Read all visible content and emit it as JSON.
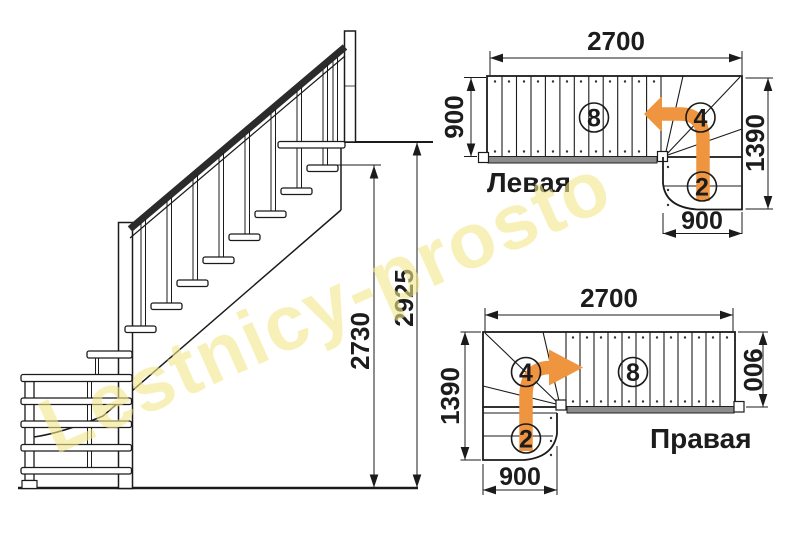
{
  "watermark": {
    "text": "Lestnicy-prosto",
    "color": "#F2E88C"
  },
  "colors": {
    "line": "#1b1b1b",
    "arrow_orange": "#EF9540",
    "stringer_gray": "#8C8C8C"
  },
  "elevation": {
    "dim_stair_height": "2730",
    "dim_total_height": "2925"
  },
  "plans": {
    "left": {
      "label": "Левая",
      "dim_length": "2700",
      "dim_width": "900",
      "dim_total_width": "1390",
      "dim_bottom_width": "900",
      "flight_steps": "8",
      "winder_steps": "4",
      "bottom_steps": "2"
    },
    "right": {
      "label": "Правая",
      "dim_length": "2700",
      "dim_width": "900",
      "dim_total_width": "1390",
      "dim_bottom_width": "900",
      "flight_steps": "8",
      "winder_steps": "4",
      "bottom_steps": "2"
    }
  }
}
